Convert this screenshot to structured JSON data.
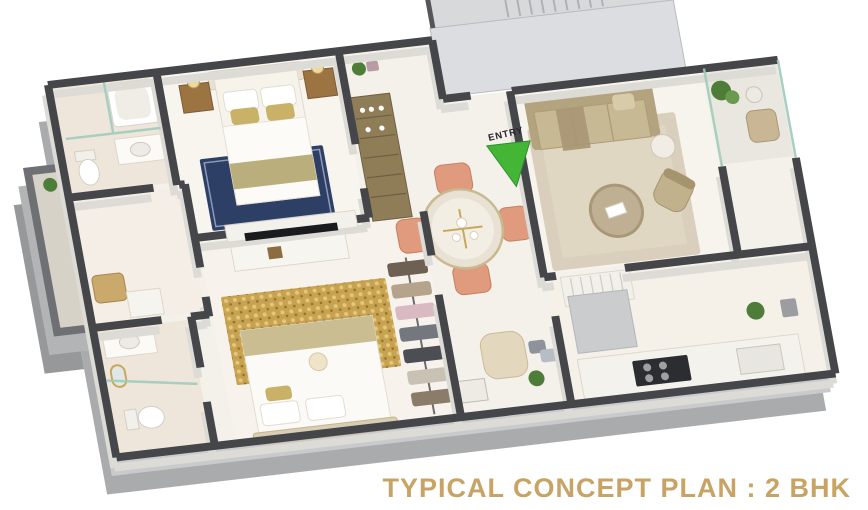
{
  "scene": {
    "type": "3d-isometric-floor-plan-render",
    "caption": {
      "text": "TYPICAL CONCEPT PLAN : 2 BHK",
      "color": "#c7a465"
    },
    "entry_marker": {
      "label": "ENTRY",
      "arrow_color": "#44b636",
      "label_color": "#26262e"
    },
    "palette": {
      "background": "#ffffff",
      "wall_cap": "#45464a",
      "wall_face": "#dddbd5",
      "exterior_face": "#aaabad",
      "exterior_face_light": "#c9cacc",
      "floor": "#f4f1ea",
      "floor_bath": "#ece4d7",
      "lobby": "#dcdde0",
      "stairs": "#d8d9db",
      "glass": "#9ecbbb",
      "rug_master": "#2e3f66",
      "rug_bedroom2": "#c8a24e",
      "rug_living": "#d5cbb6",
      "sofa": "#c8b995",
      "armchair": "#e3d8bd",
      "dining_chair": "#e09a7e",
      "wood": "#9c7442",
      "cabinet_wood": "#8f7d58",
      "white_furniture": "#f7f5f0",
      "tv": "#1a1b1e",
      "plant": "#4e7d3a",
      "counter_grey": "#cbccce"
    },
    "rooms": [
      {
        "name": "master-bedroom",
        "furniture": [
          "double-bed",
          "headboard",
          "pillows",
          "nightstand-left",
          "nightstand-right",
          "table-lamps",
          "blue-rug",
          "tv-partition-wall"
        ]
      },
      {
        "name": "bathroom-1",
        "furniture": [
          "bathtub",
          "vanity-basin",
          "toilet",
          "glass-partition"
        ]
      },
      {
        "name": "dressing-nook",
        "furniture": [
          "chair",
          "dressing-table"
        ]
      },
      {
        "name": "balcony-left",
        "furniture": [
          "railing",
          "plant-pot"
        ]
      },
      {
        "name": "bedroom-2",
        "furniture": [
          "double-bed",
          "floral-rug",
          "tv-console",
          "wall-tv",
          "cushion"
        ]
      },
      {
        "name": "wardrobe",
        "furniture": [
          "open-closet-rod",
          "hanging-clothes"
        ]
      },
      {
        "name": "bathroom-2",
        "furniture": [
          "vanity",
          "gold-mirror",
          "toilet",
          "glass-shower-partition"
        ]
      },
      {
        "name": "dining-area",
        "furniture": [
          "round-dining-table",
          "dining-chairs-x4",
          "crockery-display-cabinet",
          "coat-stand"
        ]
      },
      {
        "name": "foyer-seating",
        "furniture": [
          "armchair",
          "magazine-table",
          "plant",
          "cushions"
        ]
      },
      {
        "name": "living-room",
        "furniture": [
          "sofa",
          "throw-blanket",
          "coffee-table",
          "accent-chair",
          "side-table",
          "area-rug"
        ]
      },
      {
        "name": "balcony-right",
        "furniture": [
          "glass-railing",
          "plant",
          "outdoor-chair",
          "small-table"
        ]
      },
      {
        "name": "kitchen",
        "furniture": [
          "l-shaped-counter",
          "gas-hob",
          "sink",
          "island-unit",
          "plant",
          "appliance"
        ]
      },
      {
        "name": "staircase",
        "furniture": [
          "steps",
          "landing"
        ]
      }
    ]
  }
}
